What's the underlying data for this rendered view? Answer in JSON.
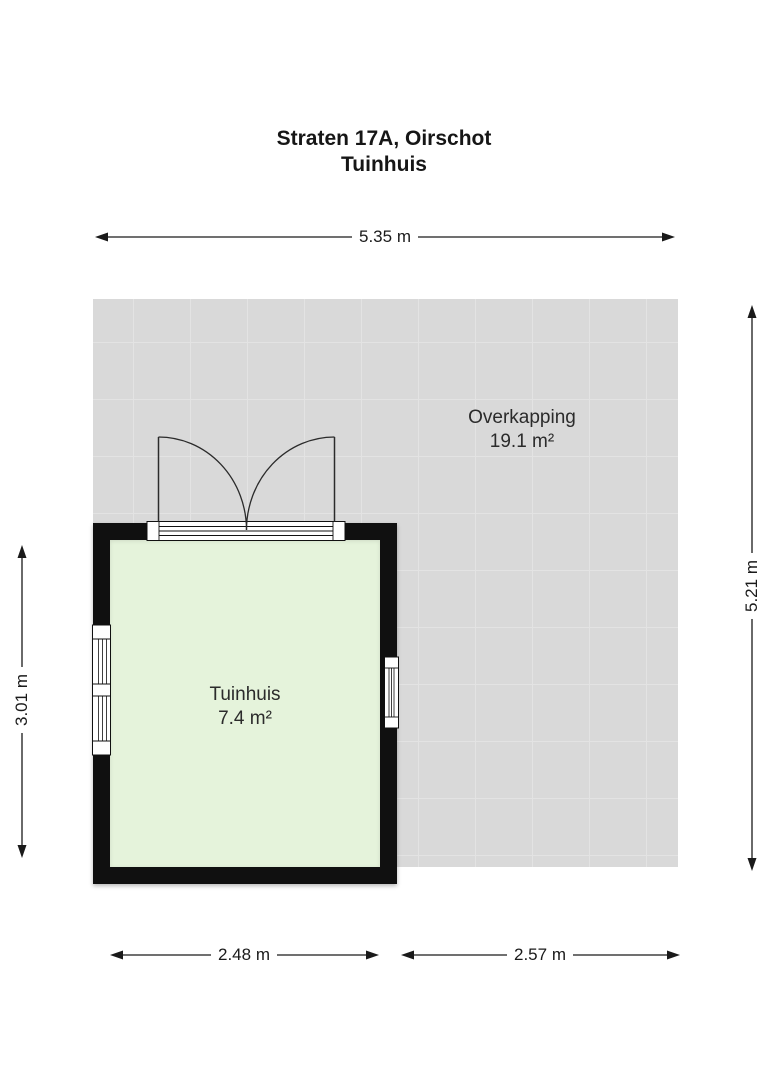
{
  "title": {
    "line1": "Straten 17A, Oirschot",
    "line2": "Tuinhuis"
  },
  "areas": {
    "overkapping": {
      "name": "Overkapping",
      "size": "19.1 m²"
    },
    "tuinhuis": {
      "name": "Tuinhuis",
      "size": "7.4 m²"
    }
  },
  "dimensions": {
    "top": "5.35 m",
    "left": "3.01 m",
    "right": "5.21 m",
    "bottom_left": "2.48 m",
    "bottom_right": "2.57 m"
  },
  "colors": {
    "wall": "#101010",
    "tuinhuis_floor": "#e5f3db",
    "overkapping_floor": "#d9d9d9",
    "grid_line": "#e3e3e3",
    "line": "#1a1a1a",
    "text": "#1f1f1f"
  }
}
